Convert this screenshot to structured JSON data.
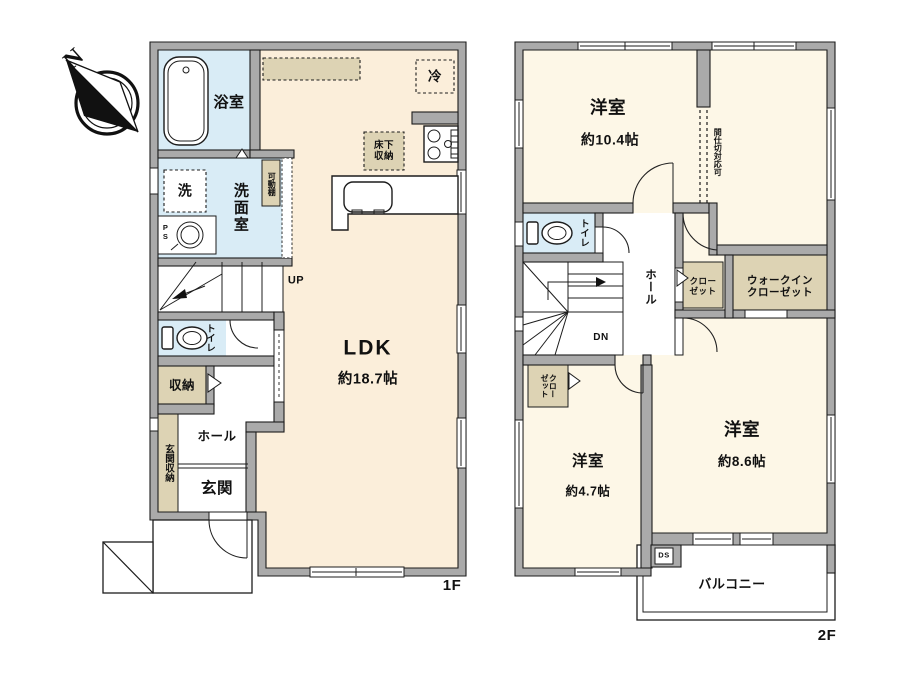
{
  "colors": {
    "wall": "#aaaaaa",
    "outline": "#1c1c1c",
    "floor_cream": "#fbeeda",
    "floor_cream_2f": "#fdf7e7",
    "wet_blue": "#d9ecf6",
    "closet_tan": "#ddd3b4",
    "paper": "#ffffff"
  },
  "compass": {
    "north": "N"
  },
  "floor1": {
    "label": "1F",
    "bathroom": "浴室",
    "washer": "洗",
    "washroom": "洗面室",
    "movable_shelf": "可動棚",
    "pipe_space": "PS",
    "stairs_up": "UP",
    "toilet": "トイレ",
    "storage": "収納",
    "entrance_storage": "玄関収納",
    "hall": "ホール",
    "entrance": "玄関",
    "ldk": "LDK",
    "ldk_size": "約18.7帖",
    "refrigerator": "冷",
    "underfloor_storage": "床下\n収納"
  },
  "floor2": {
    "label": "2F",
    "room_a": "洋室",
    "room_a_size": "約10.4帖",
    "partition_note": "間仕切対応可",
    "toilet": "トイレ",
    "hall": "ホール",
    "stairs_down": "DN",
    "closet_left": "クロー\nゼット",
    "closet_right": "クロー\nゼット",
    "walkin_closet": "ウォークイン\nクローゼット",
    "room_b": "洋室",
    "room_b_size": "約4.7帖",
    "room_c": "洋室",
    "room_c_size": "約8.6帖",
    "duct_space": "DS",
    "balcony": "バルコニー"
  }
}
